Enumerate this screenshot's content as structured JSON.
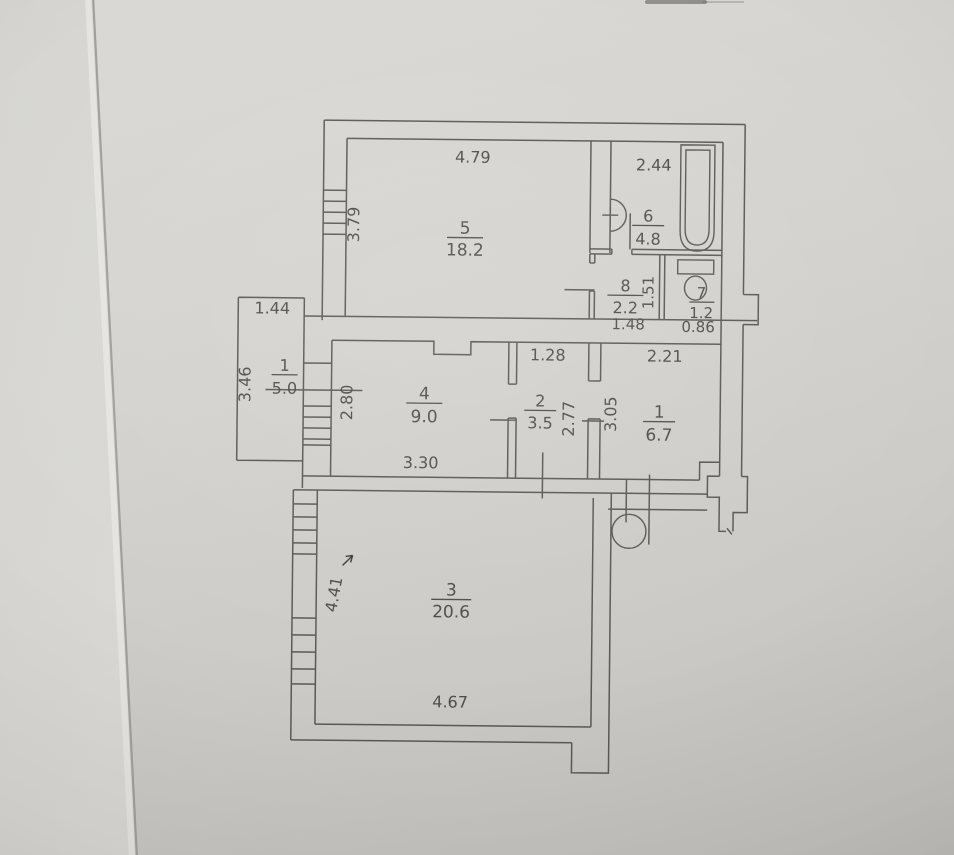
{
  "document": {
    "type": "floor-plan-photo",
    "description_labels_visible_only": true
  },
  "colors": {
    "paper": "#d4d2ce",
    "paper_edge_strip": "#dfdedb",
    "ink_lines": "#5b5955",
    "ink_text": "#514e4a",
    "pen_annotation": "#3d3b37"
  },
  "icons": {
    "bathtub": "bathtub-icon",
    "washbasin": "washbasin-icon",
    "toilet": "toilet-icon",
    "round_stove": "round-stove-icon",
    "window": "window-hatch-icon",
    "door": "door-leaf-icon"
  },
  "rooms": {
    "r5": {
      "number": "5",
      "area": "18.2"
    },
    "r6": {
      "number": "6",
      "area": "4.8"
    },
    "r8": {
      "number": "8",
      "area": "2.2"
    },
    "r7": {
      "number": "7",
      "area": "1.2"
    },
    "loggia": {
      "number": "1",
      "area": "5.0"
    },
    "r4": {
      "number": "4",
      "area": "9.0"
    },
    "r2": {
      "number": "2",
      "area": "3.5"
    },
    "r1": {
      "number": "1",
      "area": "6.7"
    },
    "r3": {
      "number": "3",
      "area": "20.6"
    }
  },
  "dimensions": {
    "w5": "4.79",
    "h5": "3.79",
    "w6": "2.44",
    "w8": "1.48",
    "h8": "1.51",
    "w7": "0.86",
    "wl": "1.44",
    "hl": "3.46",
    "w4": "3.30",
    "h4": "2.80",
    "w2": "1.28",
    "h2": "2.77",
    "w1": "2.21",
    "h1": "3.05",
    "w3": "4.67",
    "h3": "4.41"
  }
}
